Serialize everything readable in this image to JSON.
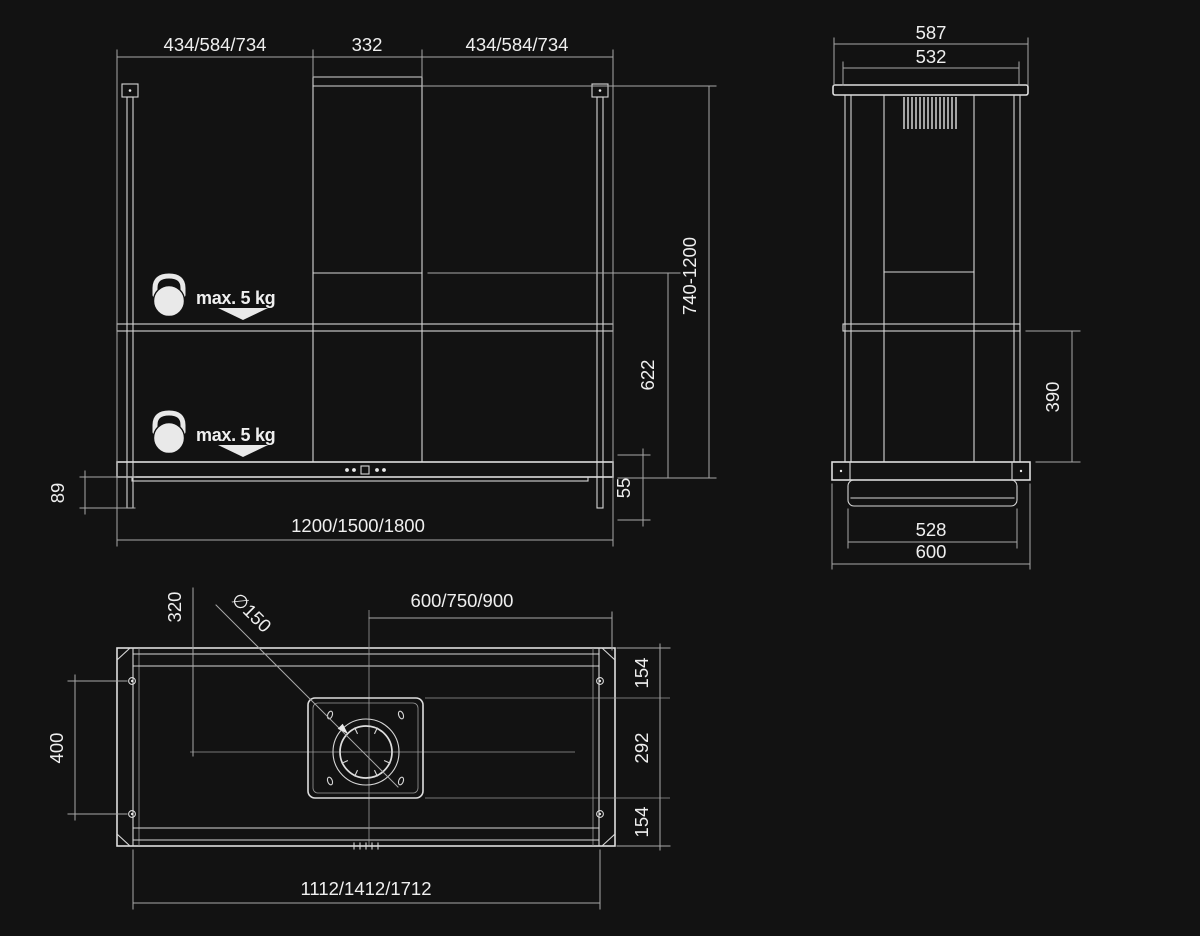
{
  "colors": {
    "background": "#121212",
    "structure_line": "#dedede",
    "dimension_line": "#a8a8a8",
    "text": "#efefef"
  },
  "front_view": {
    "top_dims": {
      "left": "434/584/734",
      "center": "332",
      "right": "434/584/734"
    },
    "height_range": "740-1200",
    "shelf_to_bottom": "622",
    "panel_gap": "55",
    "rod_extension": "89",
    "overall_width": "1200/1500/1800",
    "max_load_upper": "max. 5 kg",
    "max_load_lower": "max. 5 kg"
  },
  "side_view": {
    "overall_depth_top": "587",
    "frame_depth_top": "532",
    "shelf_drop": "390",
    "body_depth_bottom": "528",
    "overall_depth_bottom": "600"
  },
  "top_view": {
    "duct_center_offset": "320",
    "duct_diameter": "∅150",
    "half_width": "600/750/900",
    "edge_section_top": "154",
    "center_section": "292",
    "edge_section_bottom": "154",
    "rod_spacing": "400",
    "rail_length": "1112/1412/1712"
  }
}
